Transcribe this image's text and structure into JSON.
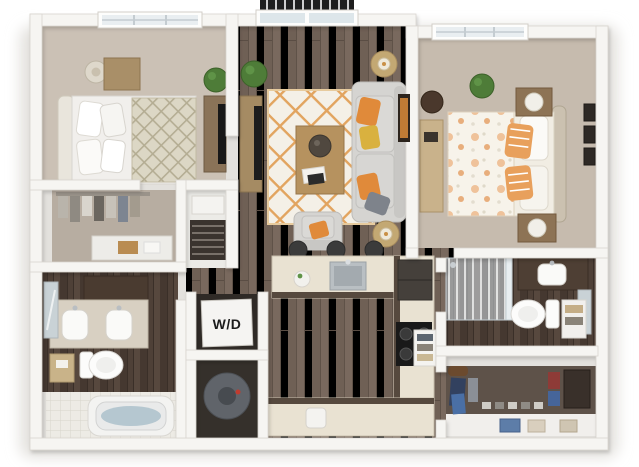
{
  "scene": {
    "kind": "3d-rendered-floor-plan",
    "background": "#ffffff"
  },
  "labels": {
    "washer_dryer": "W/D"
  },
  "palette": {
    "wall": "#f6f5f2",
    "wall_edge": "#d9d5cf",
    "wood_floor": "#79695e",
    "bedroom_floor_left": "#cbc1b5",
    "bedroom_floor_right": "#c6bbae",
    "closet_floor": "#b7ada1",
    "bath_floor_dark": "#4e4037",
    "rug_base": "#f4f0e7",
    "rug_lattice": "#e2a45f",
    "accent_orange": "#e08a3a",
    "accent_gold": "#d9b13f",
    "sofa_gray": "#d5d4d1",
    "pillow_gray": "#7e838b",
    "counter_cream": "#e9e2d2",
    "cabinet_dark": "#53463c",
    "appliance_black": "#191919",
    "plant_green": "#4e7c38",
    "water_blue": "#b5c7d0",
    "wood_furniture": "#b6925f",
    "railing_black": "#1e1e1e"
  },
  "rooms": [
    {
      "id": "bedroom-left",
      "items": [
        "window",
        "table-lamp",
        "nightstand",
        "bed-headboard",
        "pillows",
        "trellis-duvet",
        "potted-plant",
        "media-console",
        "tv"
      ]
    },
    {
      "id": "closet-left",
      "items": [
        "hanging-clothes",
        "dresser"
      ]
    },
    {
      "id": "mechanical-closet",
      "items": [
        "hvac-unit",
        "louvered-vent"
      ]
    },
    {
      "id": "living-room",
      "items": [
        "balcony-railing",
        "balcony-door",
        "potted-plant",
        "tv-console",
        "tv",
        "area-rug",
        "coffee-table",
        "decor-tray",
        "sofa",
        "accent-pillows",
        "armchair",
        "side-table-lamps",
        "wall-art"
      ]
    },
    {
      "id": "bedroom-right",
      "items": [
        "window",
        "potted-plant",
        "desk",
        "chair",
        "floral-duvet-bed",
        "striped-pillows",
        "nightstands",
        "lamps",
        "wall-frames"
      ]
    },
    {
      "id": "bathroom-left",
      "items": [
        "storage-cabinet",
        "double-vanity",
        "sinks",
        "leaning-mirror",
        "toilet",
        "hamper",
        "bathtub",
        "tile-deck"
      ]
    },
    {
      "id": "laundry-closet",
      "items": [
        "stacked-washer-dryer",
        "water-heater"
      ]
    },
    {
      "id": "kitchen",
      "items": [
        "bar-stools",
        "peninsula-counter",
        "sink",
        "faucet",
        "vase",
        "refrigerator",
        "cooktop",
        "base-cabinets",
        "small-appliance"
      ]
    },
    {
      "id": "bathroom-right",
      "items": [
        "walk-in-shower",
        "glass-panel",
        "vanity",
        "sink",
        "leaning-mirror",
        "toilet",
        "towel-shelf"
      ]
    },
    {
      "id": "hallway",
      "items": [
        "linen-shelf",
        "towels"
      ]
    },
    {
      "id": "walk-in-closet",
      "items": [
        "hanging-clothes",
        "duffel-bag",
        "shoe-row",
        "storage-boxes",
        "bench",
        "folded-items"
      ]
    }
  ]
}
